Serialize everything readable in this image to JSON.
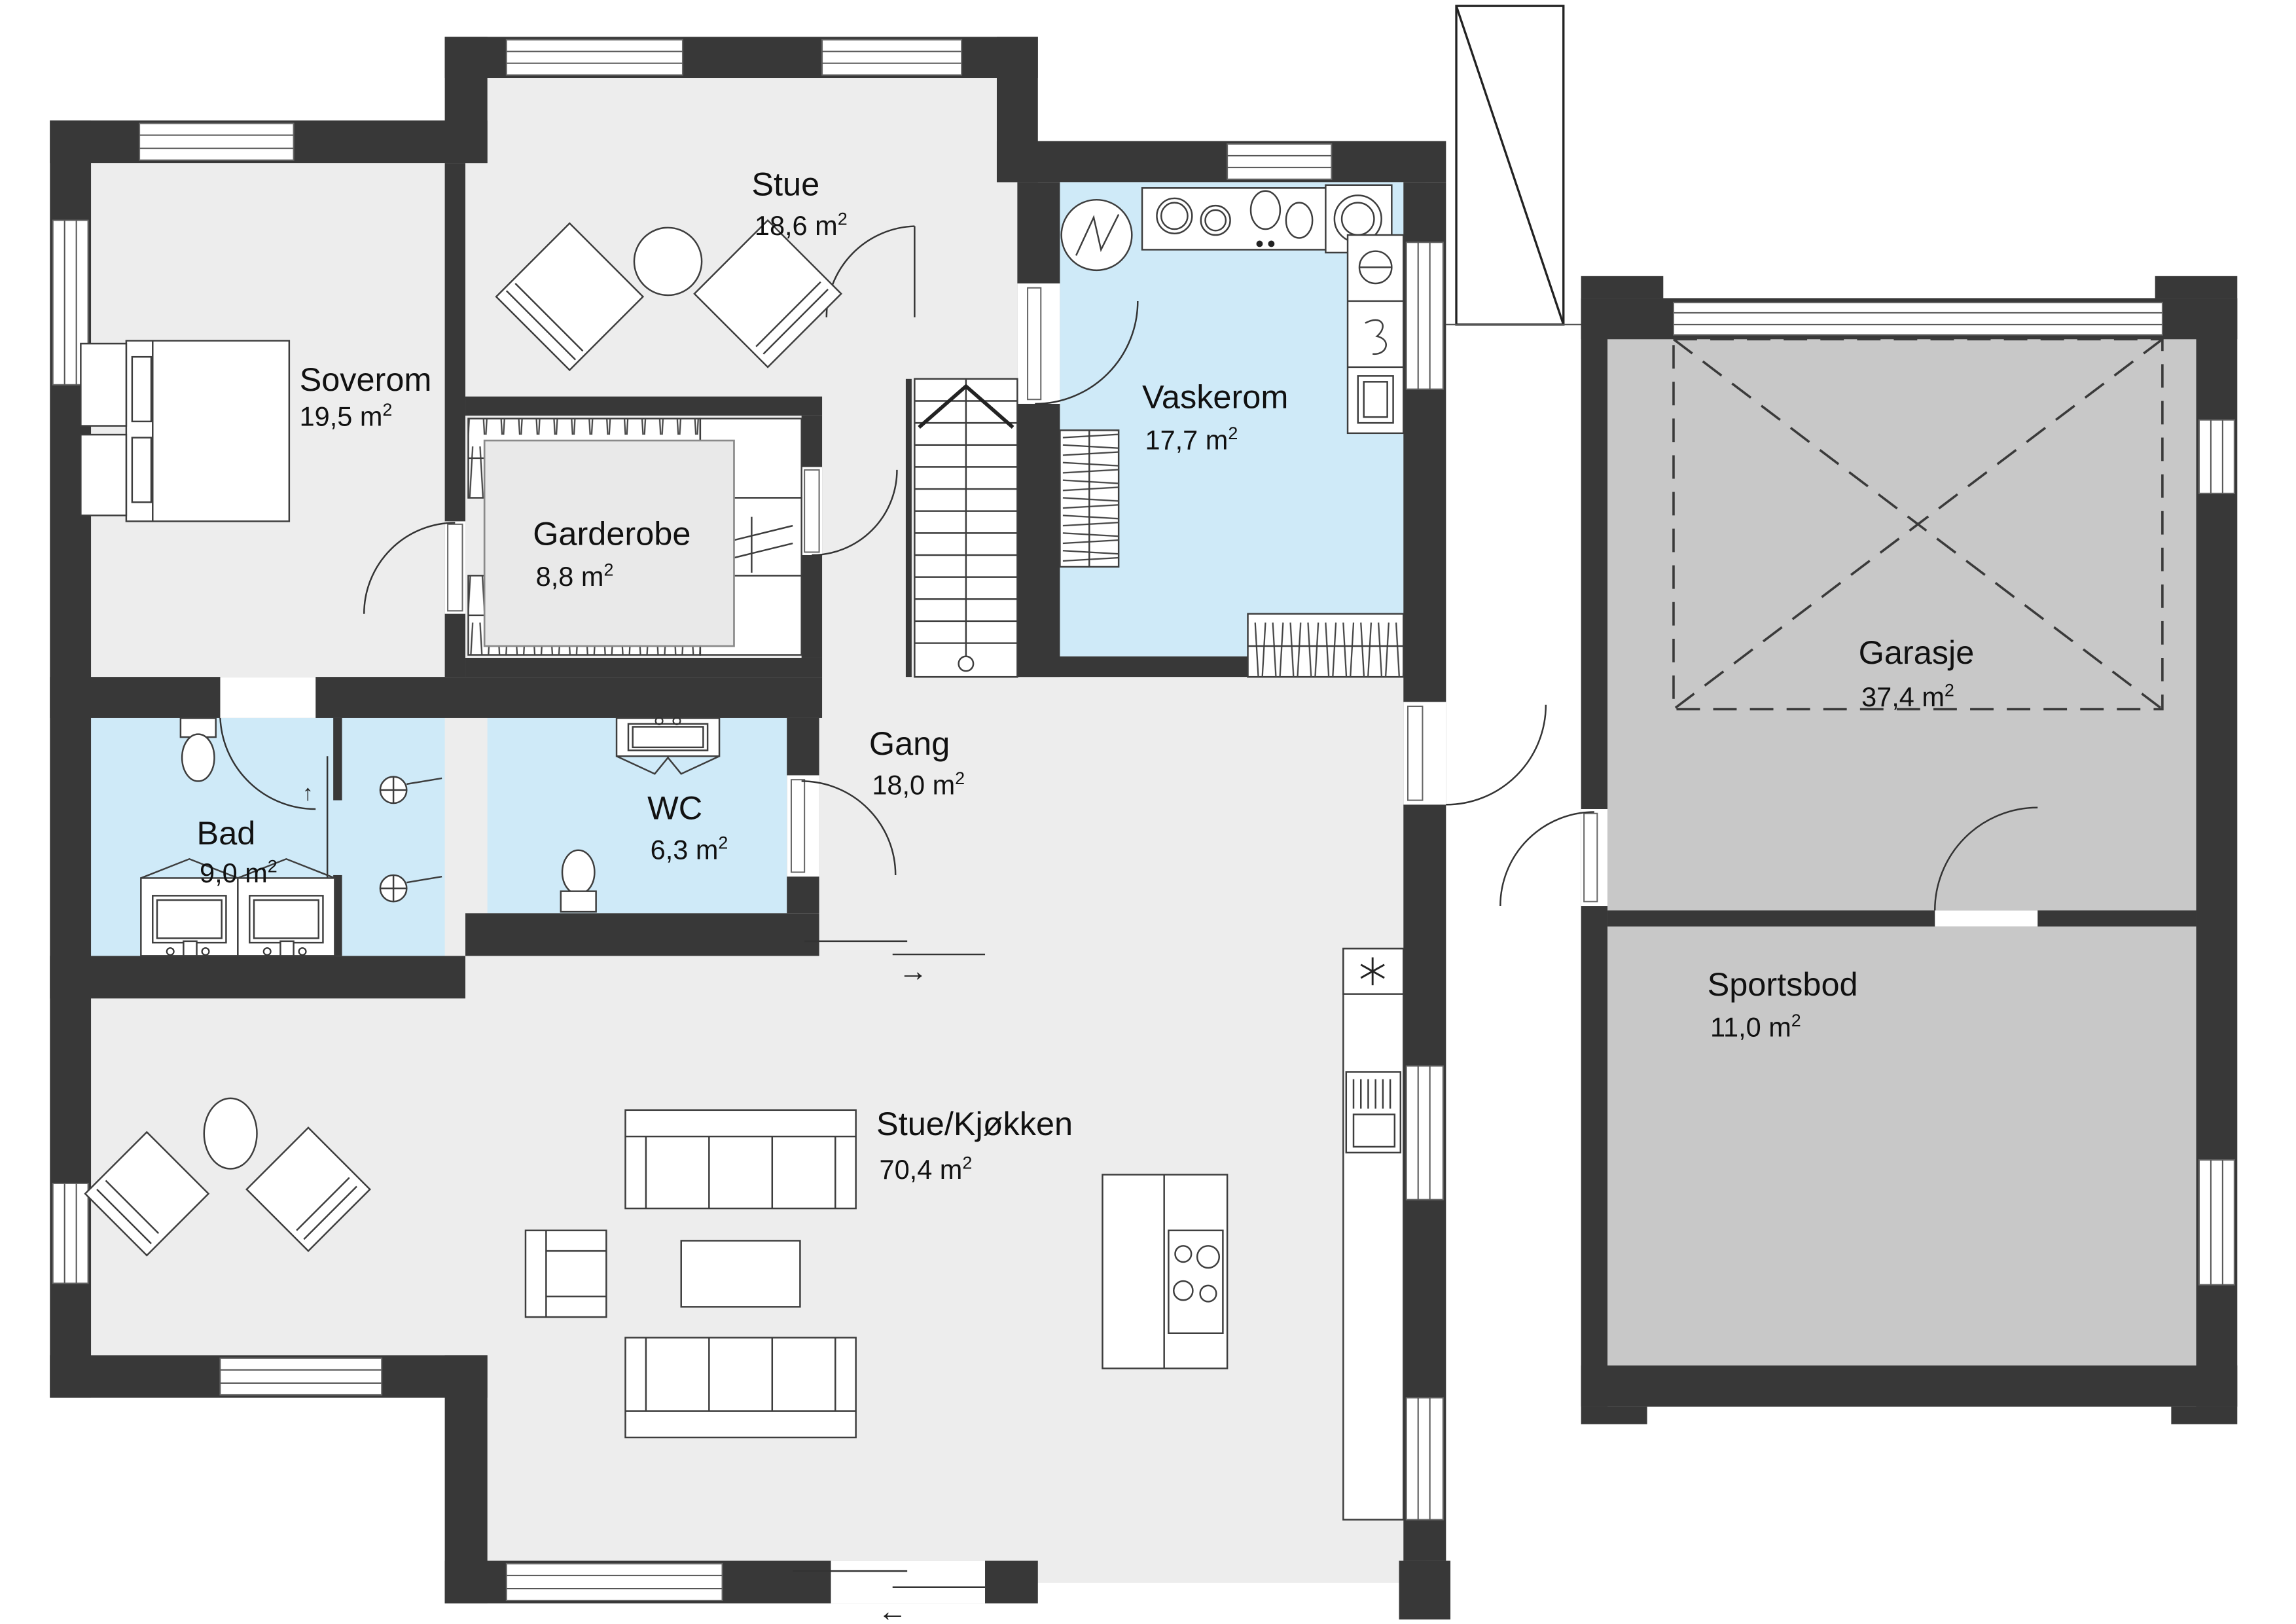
{
  "plan": {
    "rooms": {
      "soverom": {
        "name": "Soverom",
        "area": "19,5 m"
      },
      "stue": {
        "name": "Stue",
        "area": "18,6 m"
      },
      "vaskerom": {
        "name": "Vaskerom",
        "area": "17,7 m"
      },
      "garderobe": {
        "name": "Garderobe",
        "area": "8,8 m"
      },
      "gang": {
        "name": "Gang",
        "area": "18,0 m"
      },
      "bad": {
        "name": "Bad",
        "area": "9,0 m"
      },
      "wc": {
        "name": "WC",
        "area": "6,3 m"
      },
      "stue_kjokken": {
        "name": "Stue/Kjøkken",
        "area": "70,4 m"
      },
      "garasje": {
        "name": "Garasje",
        "area": "37,4 m"
      },
      "sportsbod": {
        "name": "Sportsbod",
        "area": "11,0 m"
      }
    },
    "units": {
      "sup": "2"
    },
    "symbols": {
      "slide_left": "←",
      "slide_right": "→",
      "up": "↑",
      "down": "↓"
    },
    "colors": {
      "wall": "#383838",
      "floor": "#ededed",
      "wet_room": "#cfeaf8",
      "garage": "#c8c8c8"
    }
  }
}
